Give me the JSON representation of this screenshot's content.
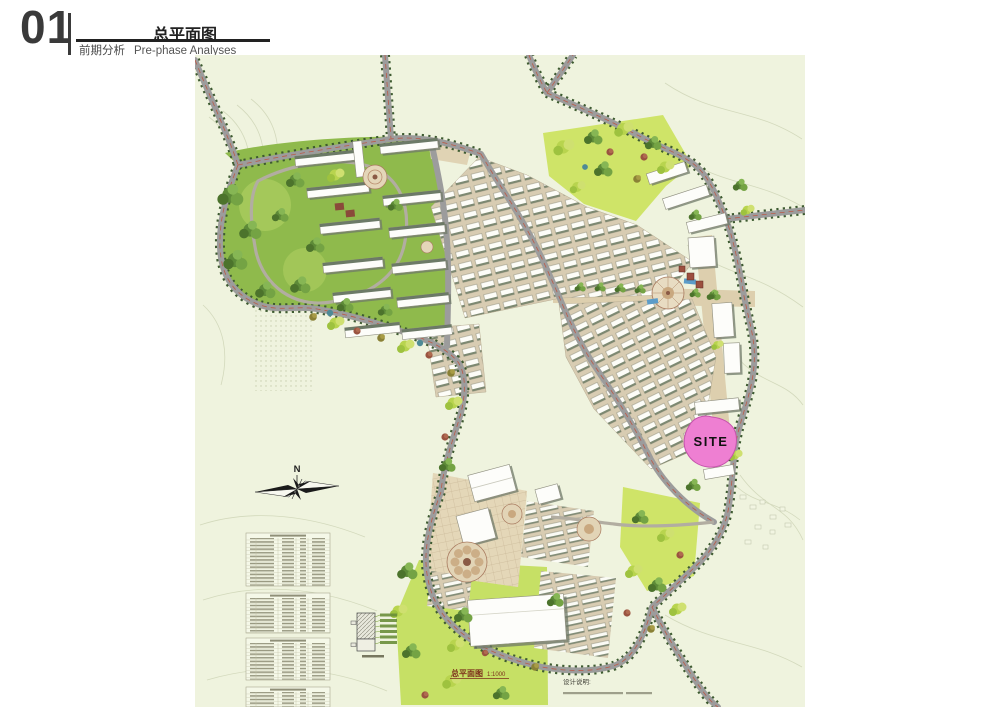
{
  "header": {
    "index": "01",
    "title": "总平面图",
    "subtitle_cn": "前期分析",
    "subtitle_en": "Pre-phase Analyses"
  },
  "map": {
    "site_label": "SITE",
    "compass_label": "N",
    "caption_title": "总平面图",
    "caption_scale": "1:1000",
    "notes_title": "设计说明:",
    "colors": {
      "site_pink": "#ee7fd2",
      "plate_bg": "#eff3de",
      "road_gray": "#9c9c9c",
      "tree_line": "#3d5a30",
      "utility_red": "#c0503c",
      "lawn_green": "#c6e065",
      "caption_red": "#7c2d1a"
    },
    "legend_tables": {
      "count": 4,
      "text_legible": false
    },
    "notes_line_legible": false
  }
}
